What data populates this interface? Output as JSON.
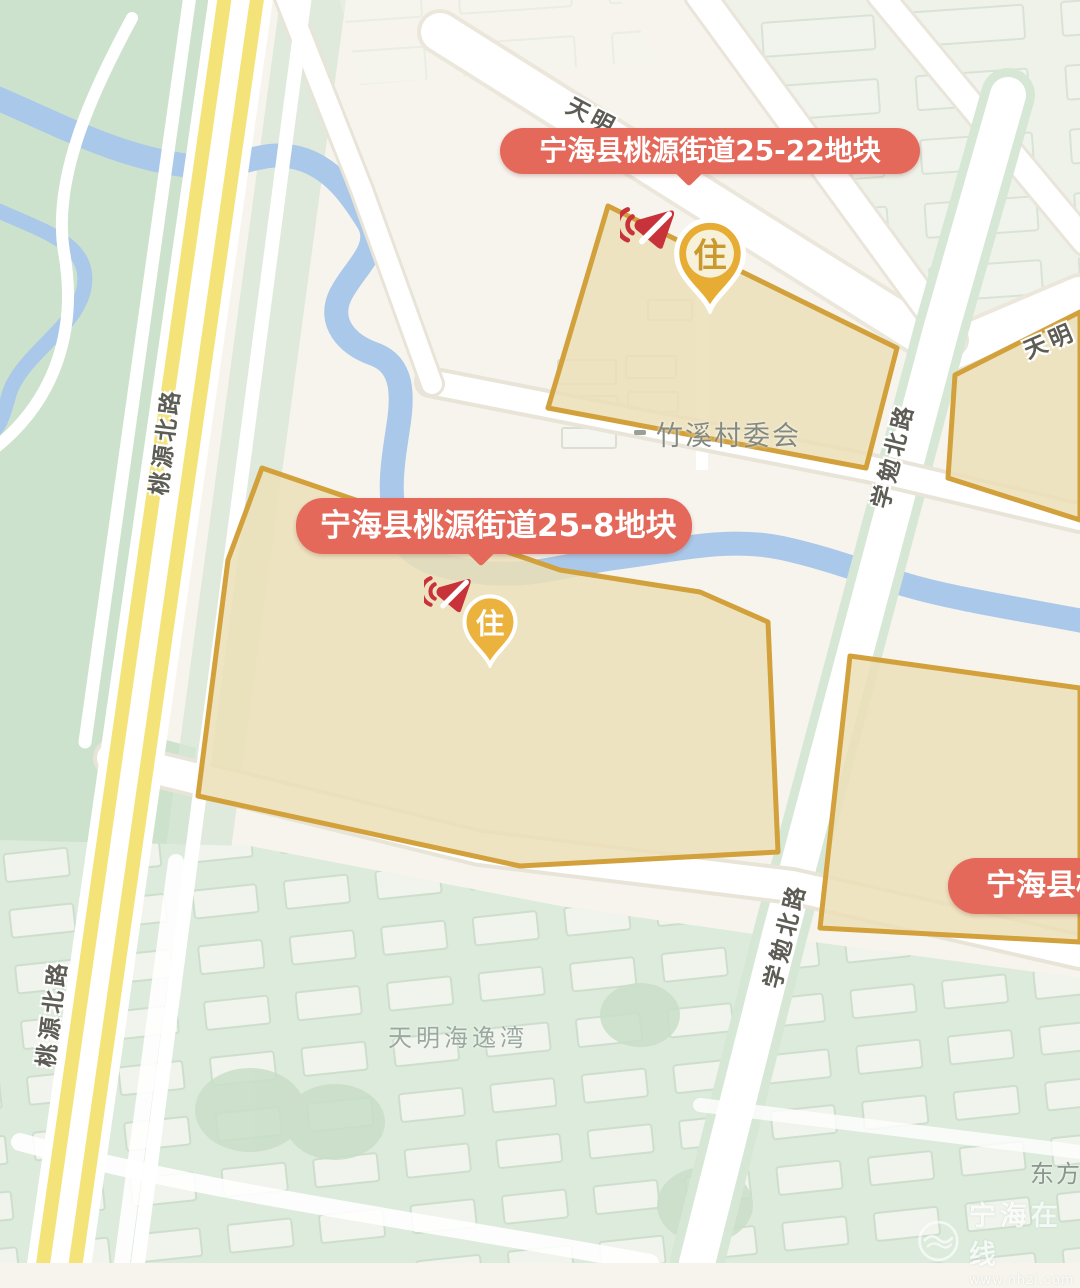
{
  "map": {
    "bubbles": [
      {
        "label": "宁海县桃源街道25-22地块"
      },
      {
        "label": "宁海县桃源街道25-8地块"
      },
      {
        "label": "宁海县桃"
      }
    ],
    "markers": [
      {
        "glyph": "住",
        "meaning": "residential parcel pin"
      },
      {
        "glyph": "住",
        "meaning": "residential parcel pin"
      }
    ],
    "road_labels": [
      {
        "name": "桃源北路"
      },
      {
        "name": "桃源北路"
      },
      {
        "name": "学勉北路"
      },
      {
        "name": "学勉北路"
      },
      {
        "name": "天明"
      },
      {
        "name": "天明"
      }
    ],
    "place_labels": [
      {
        "name": "竹溪村委会"
      },
      {
        "name": "天明海逸湾"
      },
      {
        "name": "东方"
      }
    ],
    "watermark": {
      "title": "宁海在线",
      "url": "www.nhzj.com"
    },
    "colors": {
      "bubble_bg": "#e5695b",
      "parcel_fill": "#ecdfb7",
      "parcel_border": "#d2a13c",
      "road_yellow": "#f3e379",
      "river_blue": "#aac8e9",
      "park_green": "#cde2cd",
      "residential_green": "#dcebdb",
      "pin_gold": "#e6ac33",
      "megaphone_red": "#c8333b"
    }
  }
}
